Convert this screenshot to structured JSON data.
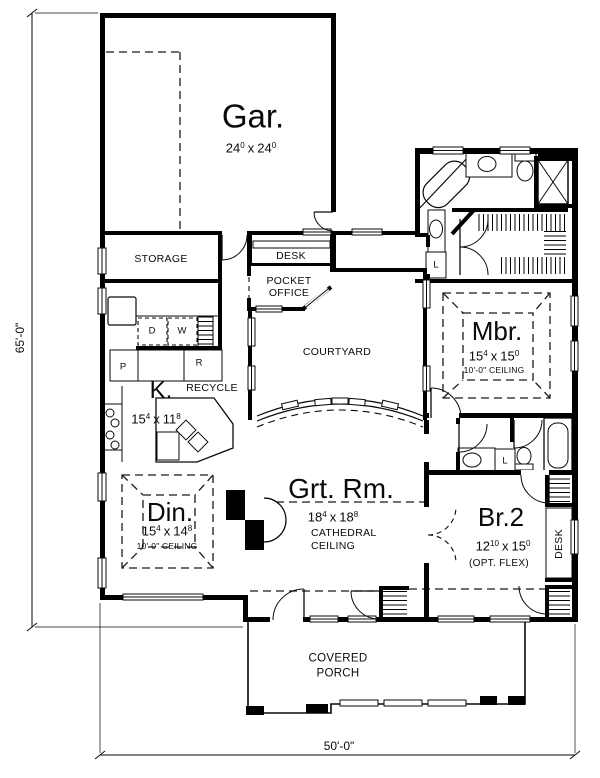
{
  "plan": {
    "dimensions": {
      "left": "65'-0\"",
      "bottom": "50'-0\""
    },
    "rooms": {
      "garage": {
        "name": "Gar.",
        "dim": {
          "a": "24",
          "ai": "0",
          "x": "x",
          "b": "24",
          "bi": "0"
        }
      },
      "storage": {
        "name": "STORAGE"
      },
      "desk_nook": {
        "name": "DESK"
      },
      "pocket_office": {
        "line1": "POCKET",
        "line2": "OFFICE"
      },
      "courtyard": {
        "name": "COURTYARD"
      },
      "master": {
        "name": "Mbr.",
        "dim": {
          "a": "15",
          "ai": "4",
          "x": "x",
          "b": "15",
          "bi": "0"
        },
        "ceiling": "10'-0\" CEILING"
      },
      "kitchen": {
        "name": "K.",
        "dim": {
          "a": "15",
          "ai": "4",
          "x": "x",
          "b": "11",
          "bi": "8"
        },
        "recycle": "RECYCLE"
      },
      "dining": {
        "name": "Din.",
        "dim": {
          "a": "15",
          "ai": "4",
          "x": "x",
          "b": "14",
          "bi": "8"
        },
        "ceiling": "10'-0\" CEILING"
      },
      "great_room": {
        "name": "Grt. Rm.",
        "dim": {
          "a": "18",
          "ai": "4",
          "x": "x",
          "b": "18",
          "bi": "8"
        },
        "ceiling1": "CATHEDRAL",
        "ceiling2": "CEILING"
      },
      "bedroom2": {
        "name": "Br.2",
        "dim": {
          "a": "12",
          "ai": "10",
          "x": "x",
          "b": "15",
          "bi": "0"
        },
        "note": "(OPT. FLEX)",
        "desk": "DESK"
      },
      "porch": {
        "line1": "COVERED",
        "line2": "PORCH"
      }
    },
    "labels": {
      "dryer": "D",
      "washer": "W",
      "pantry": "P",
      "refrigerator": "R",
      "linen_master": "L",
      "linen_bath2": "L"
    }
  }
}
